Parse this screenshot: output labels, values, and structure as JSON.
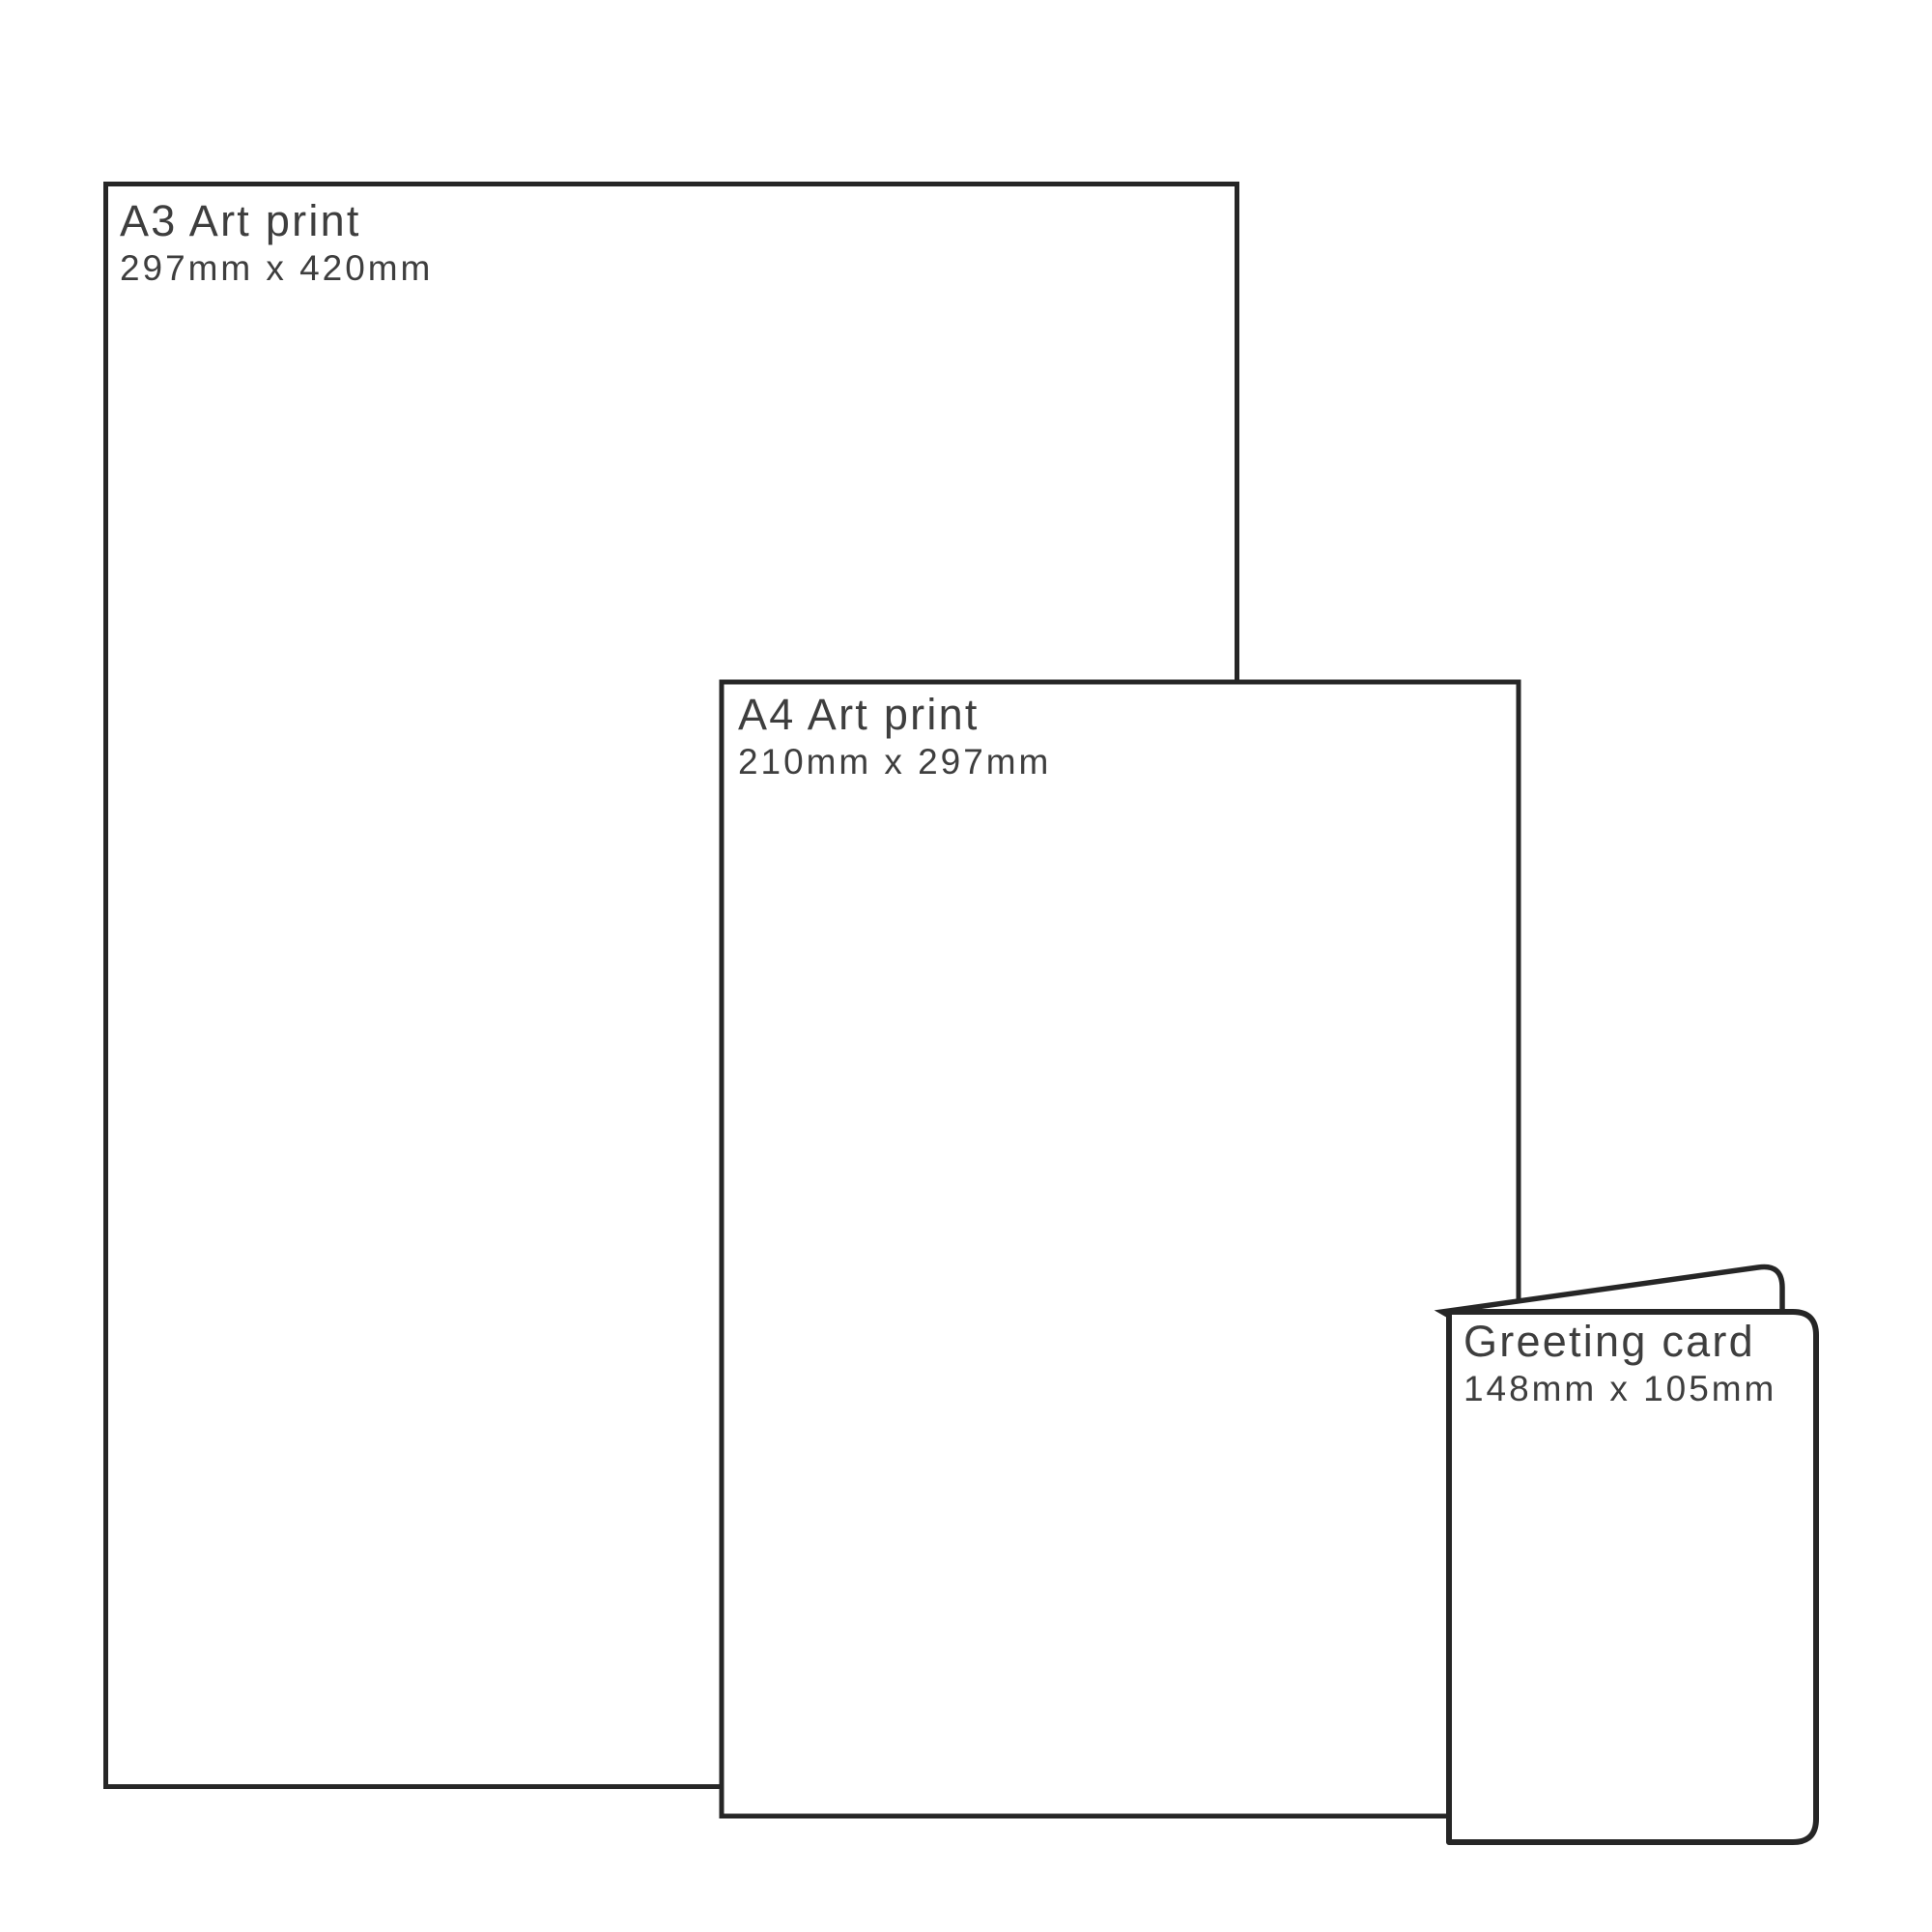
{
  "diagram": {
    "colors": {
      "outline": "#262626",
      "text": "#3e3e3e",
      "background": "#ffffff"
    },
    "items": [
      {
        "id": "a3-print",
        "title": "A3 Art print",
        "dimensions": "297mm x 420mm"
      },
      {
        "id": "a4-print",
        "title": "A4 Art print",
        "dimensions": "210mm x 297mm"
      },
      {
        "id": "greeting-card",
        "title": "Greeting card",
        "dimensions": "148mm x 105mm"
      }
    ]
  }
}
